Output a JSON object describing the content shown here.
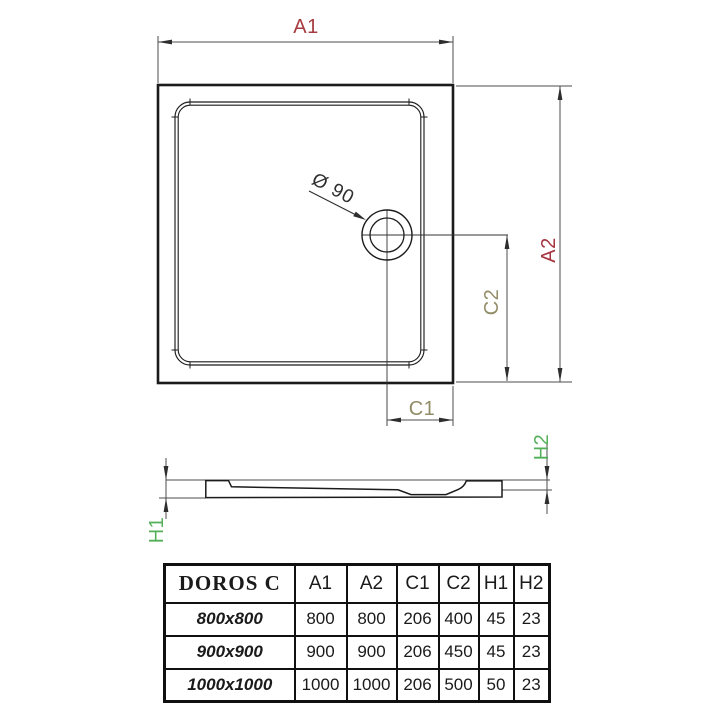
{
  "drawing": {
    "labels": {
      "a1": "A1",
      "a2": "A2",
      "c1": "C1",
      "c2": "C2",
      "h1": "H1",
      "h2": "H2",
      "drain_diameter": "Ø 90"
    }
  },
  "colors": {
    "a1_red": "#c43a40",
    "a2_dark_red": "#9e3142",
    "c_olive": "#918c66",
    "h_green": "#54b058",
    "object_line": "#1b1b1b",
    "dimension_line": "#4c4c4c"
  },
  "table": {
    "title": "DOROS C",
    "columns": [
      "A1",
      "A2",
      "C1",
      "C2",
      "H1",
      "H2"
    ],
    "rows": [
      {
        "size": "800x800",
        "values": [
          "800",
          "800",
          "206",
          "400",
          "45",
          "23"
        ]
      },
      {
        "size": "900x900",
        "values": [
          "900",
          "900",
          "206",
          "450",
          "45",
          "23"
        ]
      },
      {
        "size": "1000x1000",
        "values": [
          "1000",
          "1000",
          "206",
          "500",
          "50",
          "23"
        ]
      }
    ]
  }
}
